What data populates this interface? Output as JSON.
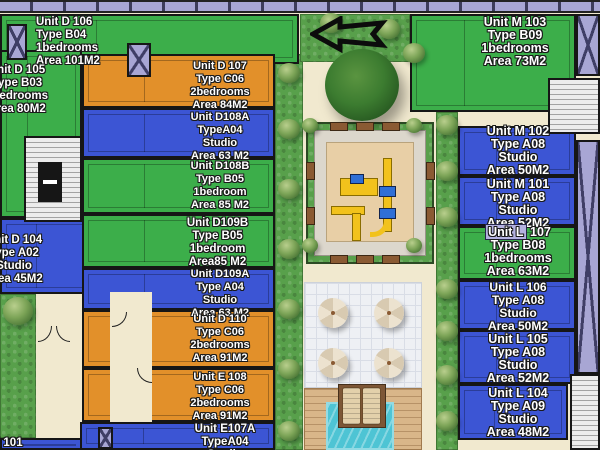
{
  "title": "residential site floor plan",
  "colors": {
    "unit_green": "#3cae4a",
    "unit_blue": "#3c55d4",
    "unit_orange": "#e2902a",
    "lavender": "#a8a6d4",
    "background_beige": "#f1e9cf",
    "grass": "#58a04b",
    "sand": "#e8cfa6",
    "pool": "#4ec4d4",
    "wood_deck": "#d9b689"
  },
  "arrow": {
    "direction": "left"
  },
  "units": [
    {
      "id": "d106",
      "lines": [
        "Unit D 106",
        "Type B04",
        "1bedrooms",
        "Area 101M2"
      ],
      "color": "green",
      "rect": [
        0,
        14,
        299,
        50
      ],
      "label": [
        36,
        16,
        120,
        "left"
      ],
      "fs": 11.5
    },
    {
      "id": "d105",
      "lines": [
        "Unit D 105",
        "Type B03",
        "1bedrooms",
        "Area 80M2"
      ],
      "color": "green",
      "rect": [
        0,
        50,
        82,
        168
      ],
      "label": [
        -42,
        64,
        118,
        "center"
      ],
      "fs": 11.5
    },
    {
      "id": "d104",
      "lines": [
        "Unit D 104",
        "Type A02",
        "Studio",
        "Area 45M2"
      ],
      "color": "blue",
      "rect": [
        0,
        218,
        110,
        76
      ],
      "label": [
        -45,
        234,
        118,
        "center"
      ],
      "fs": 11.5
    },
    {
      "id": "e101",
      "lines": [
        "Unit E 101"
      ],
      "color": "blue",
      "rect": [
        0,
        438,
        82,
        12
      ],
      "label": [
        -33,
        437,
        110,
        "left"
      ],
      "fs": 11.5
    },
    {
      "id": "d107",
      "lines": [
        "Unit D 107",
        "Type C06",
        "2bedrooms",
        "Area 84M2"
      ],
      "color": "orange",
      "rect": [
        82,
        54,
        193,
        54
      ],
      "label": [
        160,
        60,
        120,
        "center"
      ],
      "fs": 11
    },
    {
      "id": "d108a",
      "lines": [
        "Unit D108A",
        "TypeA04",
        "Studio",
        "Area 63 M2"
      ],
      "color": "blue",
      "rect": [
        82,
        108,
        193,
        50
      ],
      "label": [
        160,
        111,
        120,
        "center"
      ],
      "fs": 11
    },
    {
      "id": "d108b",
      "lines": [
        "Unit D108B",
        "Type B05",
        "1bedroom",
        "Area 85 M2"
      ],
      "color": "green",
      "rect": [
        82,
        158,
        193,
        56
      ],
      "label": [
        160,
        160,
        120,
        "center"
      ],
      "fs": 11
    },
    {
      "id": "d109b",
      "lines": [
        "Unit D109B",
        "Type B05",
        "1bedroom",
        "Area85 M2"
      ],
      "color": "green",
      "rect": [
        82,
        214,
        193,
        54
      ],
      "label": [
        155,
        217,
        125,
        "center"
      ],
      "fs": 11.5
    },
    {
      "id": "d109a",
      "lines": [
        "Unit D109A",
        "Type A04",
        "Studio",
        "Area 63 M2"
      ],
      "color": "blue",
      "rect": [
        82,
        268,
        193,
        42
      ],
      "label": [
        160,
        268,
        120,
        "center"
      ],
      "fs": 11
    },
    {
      "id": "d110",
      "lines": [
        "Unit D 110",
        "Type C06",
        "2bedrooms",
        "Area 91M2"
      ],
      "color": "orange",
      "rect": [
        82,
        310,
        193,
        58
      ],
      "label": [
        160,
        313,
        120,
        "center"
      ],
      "fs": 11
    },
    {
      "id": "e108",
      "lines": [
        "Unit E 108",
        "Type C06",
        "2bedrooms",
        "Area 91M2"
      ],
      "color": "orange",
      "rect": [
        82,
        368,
        193,
        54
      ],
      "label": [
        160,
        371,
        120,
        "center"
      ],
      "fs": 11
    },
    {
      "id": "e107a",
      "lines": [
        "Unit E107A",
        "TypeA04",
        "Studio"
      ],
      "color": "blue",
      "rect": [
        80,
        422,
        195,
        28
      ],
      "label": [
        165,
        423,
        120,
        "center"
      ],
      "fs": 11.5
    },
    {
      "id": "m103",
      "lines": [
        "Unit M 103",
        "Type B09",
        "1bedrooms",
        "Area 73M2"
      ],
      "color": "green",
      "rect": [
        410,
        14,
        166,
        98
      ],
      "label": [
        455,
        16,
        120,
        "center"
      ],
      "fs": 12.5
    },
    {
      "id": "m102",
      "lines": [
        "Unit M 102",
        "Type A08",
        "Studio",
        "Area 50M2"
      ],
      "color": "blue",
      "rect": [
        458,
        126,
        118,
        50
      ],
      "label": [
        462,
        125,
        112,
        "center"
      ],
      "fs": 12.5
    },
    {
      "id": "m101",
      "lines": [
        "Unit M 101",
        "Type A08",
        "Studio",
        "Area 52M2"
      ],
      "color": "blue",
      "rect": [
        458,
        176,
        118,
        50
      ],
      "label": [
        462,
        178,
        112,
        "center"
      ],
      "fs": 12.5
    },
    {
      "id": "l107",
      "lines": [
        "Unit L 107",
        "Type B08",
        "1bedrooms",
        "Area 63M2"
      ],
      "color": "green",
      "rect": [
        458,
        226,
        118,
        54
      ],
      "label": [
        462,
        226,
        112,
        "center"
      ],
      "fs": 12.5,
      "highlight": "Unit L"
    },
    {
      "id": "l106",
      "lines": [
        "Unit L 106",
        "Type A08",
        "Studio",
        "Area 50M2"
      ],
      "color": "blue",
      "rect": [
        458,
        280,
        118,
        50
      ],
      "label": [
        462,
        281,
        112,
        "center"
      ],
      "fs": 12
    },
    {
      "id": "l105",
      "lines": [
        "Unit L 105",
        "Type A08",
        "Studio",
        "Area 52M2"
      ],
      "color": "blue",
      "rect": [
        458,
        330,
        118,
        54
      ],
      "label": [
        462,
        333,
        112,
        "center"
      ],
      "fs": 12.5
    },
    {
      "id": "l104",
      "lines": [
        "Unit L 104",
        "Type A09",
        "Studio",
        "Area 48M2"
      ],
      "color": "blue",
      "rect": [
        458,
        384,
        110,
        56
      ],
      "label": [
        462,
        387,
        112,
        "center"
      ],
      "fs": 12.5
    }
  ],
  "landscape": {
    "strips": [
      {
        "name": "left-grass-strip",
        "rect": [
          275,
          54,
          28,
          396
        ]
      },
      {
        "name": "top-grass-strip",
        "rect": [
          300,
          14,
          110,
          48
        ]
      },
      {
        "name": "right-grass-strip",
        "rect": [
          436,
          112,
          22,
          338
        ]
      },
      {
        "name": "bottom-left-grass",
        "rect": [
          0,
          294,
          36,
          144
        ]
      }
    ],
    "bushes": [
      [
        289,
        74,
        22
      ],
      [
        289,
        130,
        22
      ],
      [
        289,
        190,
        22
      ],
      [
        289,
        250,
        22
      ],
      [
        289,
        310,
        22
      ],
      [
        289,
        370,
        22
      ],
      [
        289,
        432,
        22
      ],
      [
        331,
        24,
        22
      ],
      [
        389,
        30,
        22
      ],
      [
        414,
        54,
        22
      ],
      [
        447,
        126,
        22
      ],
      [
        447,
        172,
        22
      ],
      [
        447,
        218,
        22
      ],
      [
        447,
        290,
        22
      ],
      [
        447,
        332,
        22
      ],
      [
        447,
        376,
        22
      ],
      [
        447,
        422,
        22
      ],
      [
        18,
        312,
        30
      ]
    ],
    "corner_bushes": [
      [
        310,
        126,
        16
      ],
      [
        414,
        126,
        16
      ],
      [
        310,
        246,
        16
      ],
      [
        414,
        246,
        16
      ]
    ],
    "big_tree": {
      "cx": 362,
      "cy": 86,
      "d": 74
    }
  },
  "structures": {
    "stairs": [
      [
        24,
        136,
        58,
        86
      ],
      [
        548,
        78,
        52,
        56
      ],
      [
        570,
        374,
        30,
        76
      ]
    ],
    "elevator_shafts": [
      [
        7,
        24,
        20,
        36
      ],
      [
        127,
        43,
        24,
        34
      ],
      [
        98,
        427,
        15,
        22
      ],
      [
        576,
        14,
        24,
        62
      ],
      [
        576,
        140,
        24,
        234
      ]
    ],
    "paths": [
      [
        110,
        292,
        42,
        130
      ]
    ]
  },
  "benches": {
    "horizontal": [
      [
        330,
        122
      ],
      [
        356,
        122
      ],
      [
        382,
        122
      ],
      [
        330,
        255
      ],
      [
        356,
        255
      ],
      [
        382,
        255
      ]
    ],
    "vertical": [
      [
        306,
        162
      ],
      [
        306,
        207
      ],
      [
        426,
        162
      ],
      [
        426,
        207
      ]
    ]
  },
  "amenities": {
    "umbrella_count": 4,
    "pool": "swimming pool",
    "playground": "children playground"
  }
}
